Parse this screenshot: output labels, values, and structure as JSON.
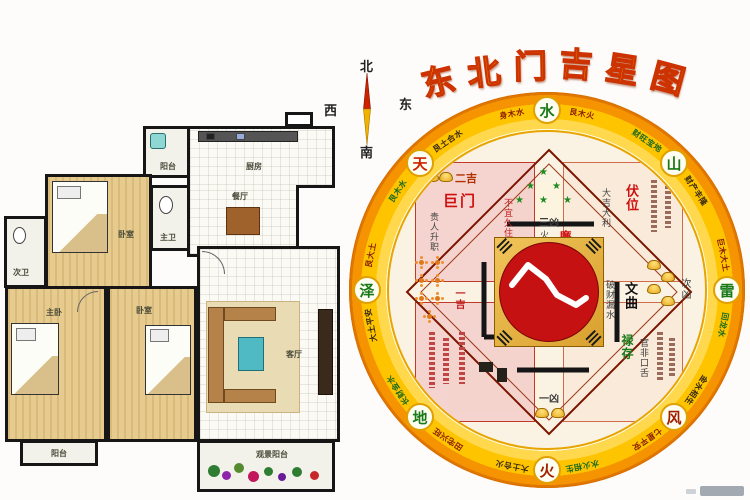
{
  "title": {
    "text": "东北门吉星图",
    "chars": [
      "东",
      "北",
      "门",
      "吉",
      "星",
      "图"
    ]
  },
  "compass": {
    "north": "北",
    "south": "南",
    "west": "西",
    "east": "东"
  },
  "floorplan": {
    "rooms": [
      {
        "id": "balcony-top",
        "label": "阳台"
      },
      {
        "id": "kitchen",
        "label": "厨房"
      },
      {
        "id": "dining",
        "label": "餐厅"
      },
      {
        "id": "bath-main",
        "label": "主卫"
      },
      {
        "id": "bedroom-top",
        "label": "卧室"
      },
      {
        "id": "bath-second",
        "label": "次卫"
      },
      {
        "id": "master-bedroom",
        "label": "主卧"
      },
      {
        "id": "bedroom-2",
        "label": "卧室"
      },
      {
        "id": "living-room",
        "label": "客厅"
      },
      {
        "id": "balcony-bottom",
        "label": "阳台"
      },
      {
        "id": "view-balcony",
        "label": "观景阳台"
      }
    ]
  },
  "wheel": {
    "trigrams": [
      {
        "dir": "N",
        "label": "水",
        "color": "#1a7a1a"
      },
      {
        "dir": "NE",
        "label": "山",
        "color": "#1a7a1a"
      },
      {
        "dir": "E",
        "label": "雷",
        "color": "#1a7a1a"
      },
      {
        "dir": "SE",
        "label": "风",
        "color": "#a02000"
      },
      {
        "dir": "S",
        "label": "火",
        "color": "#a02000"
      },
      {
        "dir": "SW",
        "label": "地",
        "color": "#1a7a1a"
      },
      {
        "dir": "W",
        "label": "泽",
        "color": "#1a7a1a"
      },
      {
        "dir": "NW",
        "label": "天",
        "color": "#cc2200"
      }
    ],
    "ring_segments": [
      "艮木火",
      "财旺宝地",
      "财产丰隆",
      "巨木大土",
      "回龙水",
      "金水相生",
      "七星平安",
      "水火相生",
      "大土合火",
      "田宅兴旺",
      "长财金水",
      "大土平安",
      "艮大土",
      "艮木水",
      "艮土合水",
      "身木水"
    ],
    "inner": {
      "top_rank": "三凶",
      "top_star": "廉贞",
      "top_note": "火海血光",
      "nw_rank": "二吉",
      "nw_star": "巨门",
      "nw_note": "贵人升职",
      "nw_warn": "不宜久住",
      "ne_star": "伏位",
      "ne_note": "大吉大利",
      "e_star": "文曲",
      "e_note": "破财漏水",
      "e_rank": "次凶",
      "w_rank": "一吉",
      "s_rank": "一凶",
      "se_star": "禄存",
      "se_note": "官非口舌"
    },
    "colors": {
      "ring_gold": "#ffc400",
      "ring_orange": "#f59300",
      "center_red": "#c51111",
      "title_yellow": "#ffd400",
      "title_outline": "#cc3300"
    }
  }
}
